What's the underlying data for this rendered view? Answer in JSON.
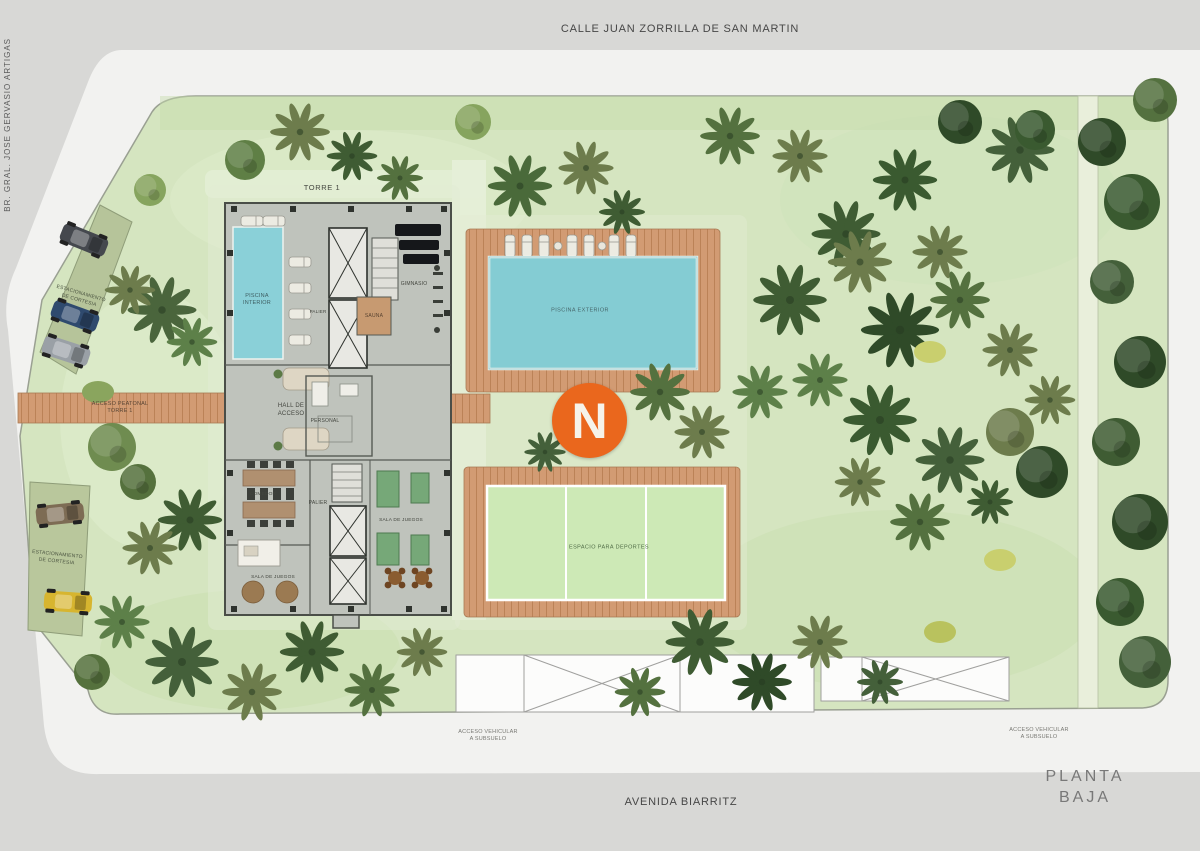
{
  "streets": {
    "top": "CALLE JUAN ZORRILLA DE SAN MARTIN",
    "left": "BR. GRAL. JOSE GERVASIO ARTIGAS",
    "bottom": "AVENIDA BIARRITZ"
  },
  "plan": {
    "title": "PLANTA BAJA"
  },
  "logo": {
    "letter": "N",
    "style": "background:#EA671D"
  },
  "tower": {
    "name": "TORRE 1"
  },
  "rooms": {
    "piscina_interior": "PISCINA\nINTERIOR",
    "gimnasio": "GIMNASIO",
    "sauna": "SAUNA",
    "palier_upper": "PALIER",
    "hall": "HALL DE\nACCESO",
    "personal": "PERSONAL",
    "comedor": "COMEDOR",
    "palier_lower": "PALIER",
    "sala_juegos_oeste": "SALA DE JUEGOS",
    "sala_juegos_este": "SALA DE JUEGOS"
  },
  "exterior": {
    "piscina_exterior": "PISCINA EXTERIOR",
    "espacio_deportes": "ESPACIO PARA DEPORTES",
    "acceso_peatonal": "ACCESO PEATONAL\nTORRE 1",
    "estacionamiento_norte": "ESTACIONAMIENTO\nDE CORTESIA",
    "estacionamiento_sur": "ESTACIONAMIENTO\nDE CORTESIA",
    "acceso_vehicular_oeste": "ACCESO VEHICULAR\nA SUBSUELO",
    "acceso_vehicular_este": "ACCESO VEHICULAR\nA SUBSUELO"
  },
  "colors": {
    "accent_orange": "#EA671D",
    "pool_water": "#84CCD3",
    "indoor_pool": "#8AD0D8",
    "wood_deck": "#D29B73",
    "sport_court": "#CDE9B6",
    "building": "#BFC3BC",
    "grass": "#D5E5C0",
    "sidewalk": "#F2F2F0",
    "background": "#D8D8D6"
  }
}
